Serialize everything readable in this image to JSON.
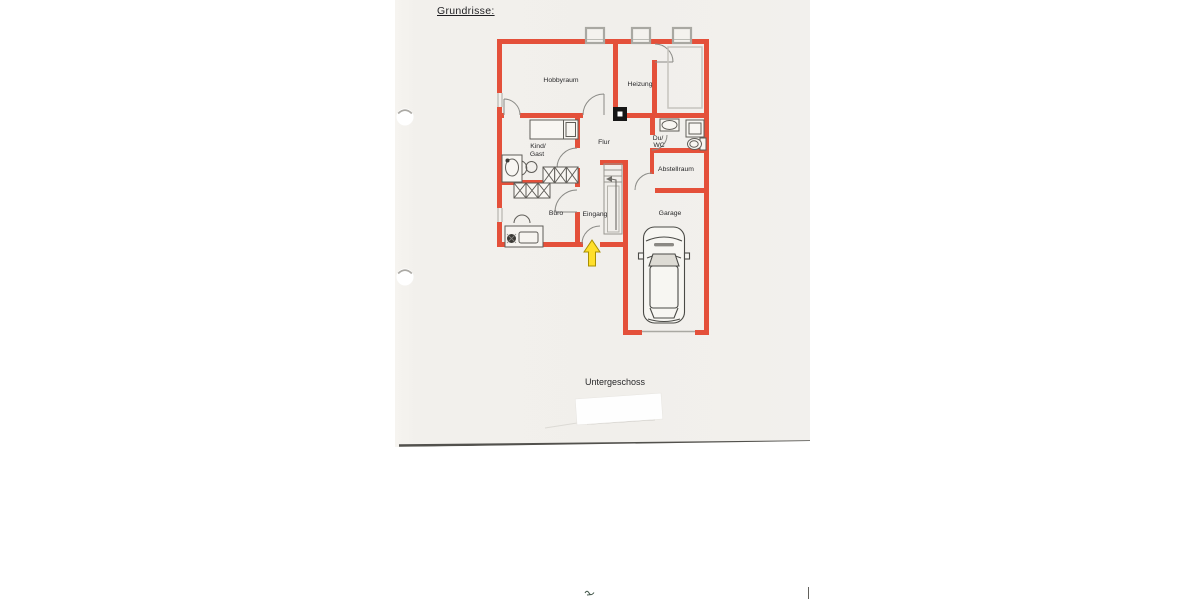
{
  "document": {
    "title": "Grundrisse:",
    "floor_caption": "Untergeschoss"
  },
  "floorplan": {
    "rooms": {
      "hobbyraum": "Hobbyraum",
      "heizung": "Heizung",
      "flur": "Flur",
      "kind_gast_line1": "Kind/",
      "kind_gast_line2": "Gast",
      "du_wc_line1": "Du/",
      "du_wc_line2": "WC",
      "abstellraum": "Abstellraum",
      "buero": "Büro",
      "eingang": "Eingang",
      "garage": "Garage"
    },
    "colors": {
      "wall": "#e4503a",
      "furniture_line": "#5f5d58",
      "window_gray": "#a9a8a2",
      "entrance_arrow_fill": "#ffdf2b",
      "entrance_arrow_stroke": "#a98f00",
      "paper": "#f2f0ec"
    }
  }
}
